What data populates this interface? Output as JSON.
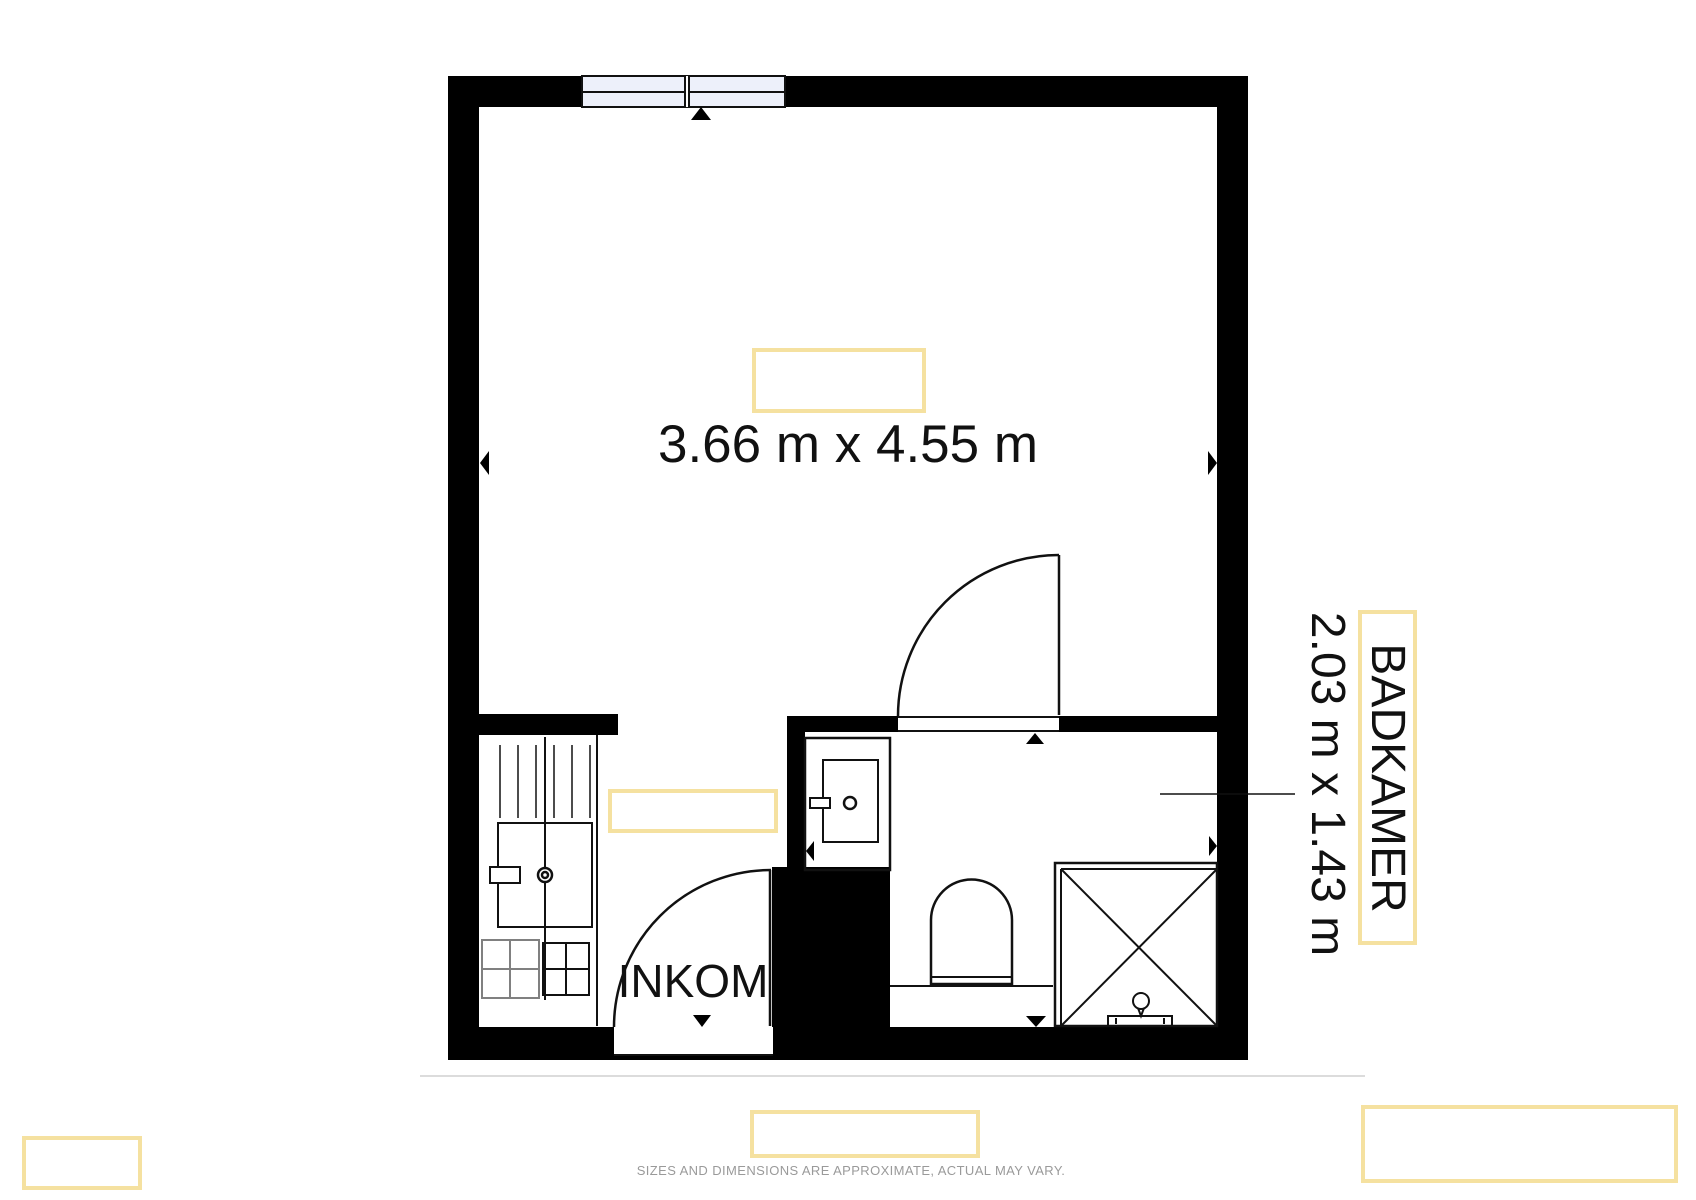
{
  "floorplan": {
    "rooms": {
      "main_room": {
        "dimensions_label": "3.66 m x 4.55 m"
      },
      "entrance": {
        "name_label": "INKOM"
      },
      "bathroom": {
        "name_label": "BADKAMER",
        "dimensions_label": "2.03 m x 1.43 m"
      }
    },
    "disclaimer": "SIZES AND DIMENSIONS ARE APPROXIMATE, ACTUAL MAY VARY.",
    "colors": {
      "wall": "#000000",
      "line": "#111111",
      "highlight_border": "#f5e1a0",
      "window_fill": "#edf0fa",
      "disclaimer_text": "#9a9a9a",
      "stove_gray": "#808080"
    }
  }
}
